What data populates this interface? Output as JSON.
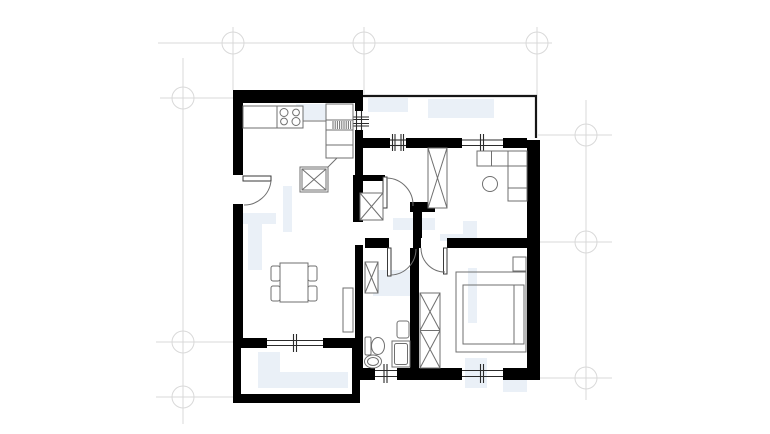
{
  "page": {
    "background": "#ffffff",
    "kind": "architectural-floor-plan-drawing",
    "visible_text": []
  },
  "colors": {
    "wall": "#000000",
    "furn": "#6f6f6f",
    "furndark": "#3a3a3a",
    "grid": "#d9d9d9",
    "win": "#2b2b2b",
    "bal": "#161616",
    "wm": "#eaf0f7"
  },
  "plan": {
    "grid_markers": {
      "count": 9,
      "shape": "circle-with-crosshair"
    },
    "rooms": [
      {
        "name": "kitchen-living-room",
        "fixtures": [
          "kitchen-counter",
          "stove-4-burners",
          "tall-kitchen-unit",
          "kitchen-island",
          "dining-table",
          "dining-chairs-x4",
          "sideboard",
          "entrance-door"
        ]
      },
      {
        "name": "bedroom-top-right",
        "fixtures": [
          "wardrobe",
          "corner-sofa",
          "round-table",
          "room-door"
        ]
      },
      {
        "name": "bedroom-bottom-right",
        "fixtures": [
          "double-bed",
          "nightstand",
          "double-wardrobe",
          "room-door",
          "window"
        ]
      },
      {
        "name": "bathroom",
        "fixtures": [
          "toilet",
          "wash-oval",
          "washbasin",
          "shower",
          "tall-cabinet",
          "room-door",
          "window"
        ]
      },
      {
        "name": "balcony-top-right",
        "fixtures": []
      },
      {
        "name": "balcony-bottom-left",
        "fixtures": []
      },
      {
        "name": "hallway-corridor",
        "fixtures": [
          "service-shaft"
        ]
      }
    ],
    "windows_count": 6,
    "doors_count": 4
  }
}
